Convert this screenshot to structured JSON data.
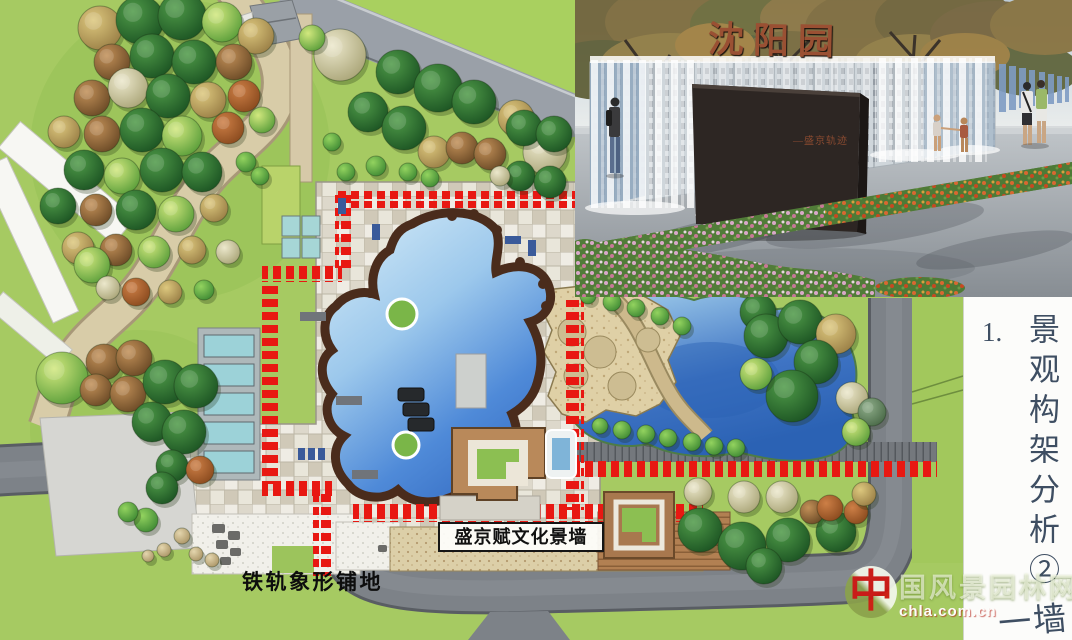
{
  "side_panel": {
    "index": "1.",
    "title": "景观构架分析②",
    "next_title": "一墙"
  },
  "plan_labels": {
    "rail_paving": "铁轨象形铺地",
    "culture_wall": "盛京赋文化景墙"
  },
  "photo": {
    "sign_title": "沈阳园",
    "sign_subtitle": "—盛京轨迹"
  },
  "watermark": {
    "logo_char": "中",
    "site_name": "国风景园林网",
    "site_domain": "chla.com.cn"
  },
  "colors": {
    "axis_red": "#e81812",
    "water": "#4f8ad8",
    "lawn": "#a6ca62",
    "road": "#7d8288",
    "sign_text": "#9a5033"
  },
  "plan": {
    "trees": [
      [
        100,
        28,
        22,
        "kh"
      ],
      [
        140,
        20,
        24,
        "dg"
      ],
      [
        182,
        16,
        24,
        "dg"
      ],
      [
        222,
        22,
        20,
        "bg"
      ],
      [
        256,
        36,
        18,
        "kh"
      ],
      [
        112,
        62,
        18,
        "br"
      ],
      [
        152,
        56,
        22,
        "dg"
      ],
      [
        194,
        62,
        22,
        "dg"
      ],
      [
        234,
        62,
        18,
        "br"
      ],
      [
        92,
        98,
        18,
        "br"
      ],
      [
        128,
        88,
        20,
        "pa"
      ],
      [
        168,
        96,
        22,
        "dg"
      ],
      [
        208,
        100,
        18,
        "kh"
      ],
      [
        244,
        96,
        16,
        "ru"
      ],
      [
        64,
        132,
        16,
        "kh"
      ],
      [
        102,
        134,
        18,
        "br"
      ],
      [
        142,
        130,
        22,
        "dg"
      ],
      [
        182,
        136,
        20,
        "bg"
      ],
      [
        228,
        128,
        16,
        "ru"
      ],
      [
        262,
        120,
        13,
        "bg"
      ],
      [
        84,
        170,
        20,
        "dg"
      ],
      [
        122,
        176,
        18,
        "bg"
      ],
      [
        162,
        170,
        22,
        "dg"
      ],
      [
        202,
        172,
        20,
        "dg"
      ],
      [
        246,
        162,
        10,
        "sh"
      ],
      [
        260,
        176,
        9,
        "sh"
      ],
      [
        58,
        206,
        18,
        "dg"
      ],
      [
        96,
        210,
        16,
        "br"
      ],
      [
        136,
        210,
        20,
        "dg"
      ],
      [
        176,
        214,
        18,
        "bg"
      ],
      [
        214,
        208,
        14,
        "kh"
      ],
      [
        78,
        248,
        16,
        "kh"
      ],
      [
        116,
        250,
        16,
        "br"
      ],
      [
        154,
        252,
        16,
        "bg"
      ],
      [
        192,
        250,
        14,
        "kh"
      ],
      [
        228,
        252,
        12,
        "pa"
      ],
      [
        92,
        265,
        18,
        "bg"
      ],
      [
        108,
        288,
        12,
        "pa"
      ],
      [
        136,
        292,
        14,
        "ru"
      ],
      [
        170,
        292,
        12,
        "kh"
      ],
      [
        204,
        290,
        10,
        "sh"
      ],
      [
        340,
        55,
        26,
        "pa"
      ],
      [
        312,
        38,
        13,
        "bg"
      ],
      [
        398,
        72,
        22,
        "dg"
      ],
      [
        438,
        88,
        24,
        "dg"
      ],
      [
        474,
        102,
        22,
        "dg"
      ],
      [
        516,
        118,
        18,
        "kh"
      ],
      [
        545,
        152,
        22,
        "pa"
      ],
      [
        368,
        112,
        20,
        "dg"
      ],
      [
        404,
        128,
        22,
        "dg"
      ],
      [
        434,
        152,
        16,
        "kh"
      ],
      [
        462,
        148,
        16,
        "br"
      ],
      [
        490,
        154,
        16,
        "br"
      ],
      [
        524,
        128,
        18,
        "dg"
      ],
      [
        554,
        134,
        18,
        "dg"
      ],
      [
        520,
        176,
        15,
        "dg"
      ],
      [
        550,
        182,
        16,
        "dg"
      ],
      [
        500,
        176,
        10,
        "pa"
      ],
      [
        332,
        142,
        9,
        "sh"
      ],
      [
        346,
        172,
        9,
        "sh"
      ],
      [
        376,
        166,
        10,
        "sh"
      ],
      [
        408,
        172,
        9,
        "sh"
      ],
      [
        430,
        178,
        9,
        "sh"
      ],
      [
        588,
        296,
        8,
        "sh"
      ],
      [
        612,
        302,
        9,
        "sh"
      ],
      [
        636,
        308,
        9,
        "sh"
      ],
      [
        660,
        316,
        9,
        "sh"
      ],
      [
        682,
        326,
        9,
        "sh"
      ],
      [
        758,
        312,
        18,
        "dg"
      ],
      [
        766,
        336,
        22,
        "dg"
      ],
      [
        800,
        322,
        22,
        "dg"
      ],
      [
        836,
        334,
        20,
        "kh"
      ],
      [
        816,
        362,
        22,
        "dg"
      ],
      [
        792,
        396,
        26,
        "dg"
      ],
      [
        756,
        374,
        16,
        "bg"
      ],
      [
        852,
        398,
        16,
        "pa"
      ],
      [
        872,
        412,
        14,
        "mg"
      ],
      [
        856,
        432,
        14,
        "bg"
      ],
      [
        600,
        426,
        8,
        "sh"
      ],
      [
        622,
        430,
        9,
        "sh"
      ],
      [
        646,
        434,
        9,
        "sh"
      ],
      [
        668,
        438,
        9,
        "sh"
      ],
      [
        692,
        442,
        9,
        "sh"
      ],
      [
        714,
        446,
        9,
        "sh"
      ],
      [
        736,
        448,
        9,
        "sh"
      ],
      [
        698,
        492,
        14,
        "pa"
      ],
      [
        744,
        497,
        16,
        "pa"
      ],
      [
        782,
        497,
        16,
        "pa"
      ],
      [
        700,
        530,
        22,
        "dg"
      ],
      [
        742,
        546,
        24,
        "dg"
      ],
      [
        788,
        540,
        22,
        "dg"
      ],
      [
        836,
        532,
        20,
        "dg"
      ],
      [
        812,
        512,
        12,
        "br"
      ],
      [
        830,
        508,
        13,
        "ru"
      ],
      [
        856,
        512,
        12,
        "ru"
      ],
      [
        864,
        494,
        12,
        "kh"
      ],
      [
        764,
        566,
        18,
        "dg"
      ],
      [
        62,
        378,
        26,
        "bg"
      ],
      [
        104,
        362,
        18,
        "br"
      ],
      [
        134,
        358,
        18,
        "br"
      ],
      [
        96,
        390,
        16,
        "br"
      ],
      [
        128,
        394,
        18,
        "br"
      ],
      [
        165,
        382,
        22,
        "dg"
      ],
      [
        196,
        386,
        22,
        "dg"
      ],
      [
        152,
        422,
        20,
        "dg"
      ],
      [
        184,
        432,
        22,
        "dg"
      ],
      [
        172,
        466,
        16,
        "dg"
      ],
      [
        200,
        470,
        14,
        "ru"
      ],
      [
        162,
        488,
        16,
        "dg"
      ],
      [
        146,
        520,
        12,
        "sh"
      ],
      [
        128,
        512,
        10,
        "sh"
      ],
      [
        182,
        536,
        8,
        "st"
      ],
      [
        164,
        550,
        7,
        "st"
      ],
      [
        196,
        554,
        7,
        "st"
      ],
      [
        148,
        556,
        6,
        "st"
      ],
      [
        212,
        560,
        7,
        "st"
      ]
    ]
  }
}
